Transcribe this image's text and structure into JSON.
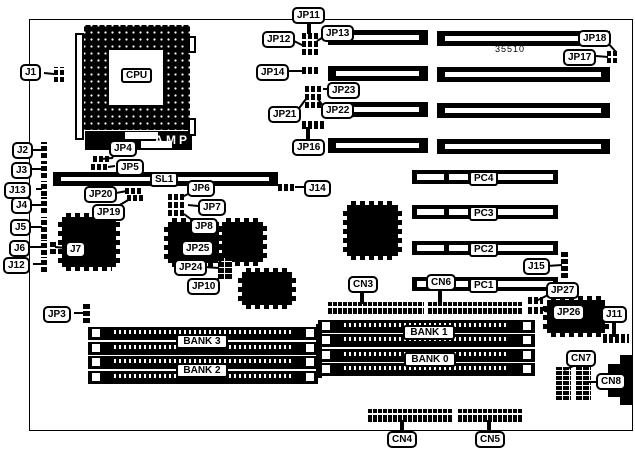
{
  "diagram": {
    "board_number": "35510",
    "cpu": "CPU",
    "amp": "AMP",
    "sl1": "SL1",
    "pci": {
      "pc4": "PC4",
      "pc3": "PC3",
      "pc2": "PC2",
      "pc1": "PC1"
    },
    "banks": {
      "bank3": "BANK 3",
      "bank2": "BANK 2",
      "bank1": "BANK 1",
      "bank0": "BANK 0"
    },
    "callouts": {
      "j1": "J1",
      "j2": "J2",
      "j3": "J3",
      "j13": "J13",
      "j4": "J4",
      "j5": "J5",
      "j6": "J6",
      "j12": "J12",
      "j7": "J7",
      "jp3": "JP3",
      "jp4": "JP4",
      "jp5": "JP5",
      "jp20": "JP20",
      "jp19": "JP19",
      "jp6": "JP6",
      "jp7": "JP7",
      "jp8": "JP8",
      "jp25": "JP25",
      "jp24": "JP24",
      "jp10": "JP10",
      "j14": "J14",
      "jp11": "JP11",
      "jp12": "JP12",
      "jp13": "JP13",
      "jp14": "JP14",
      "jp23": "JP23",
      "jp21": "JP21",
      "jp22": "JP22",
      "jp16": "JP16",
      "jp18": "JP18",
      "jp17": "JP17",
      "j15": "J15",
      "cn3": "CN3",
      "cn6": "CN6",
      "jp27": "JP27",
      "jp26": "JP26",
      "j11": "J11",
      "cn7": "CN7",
      "cn8": "CN8",
      "cn4": "CN4",
      "cn5": "CN5"
    }
  }
}
